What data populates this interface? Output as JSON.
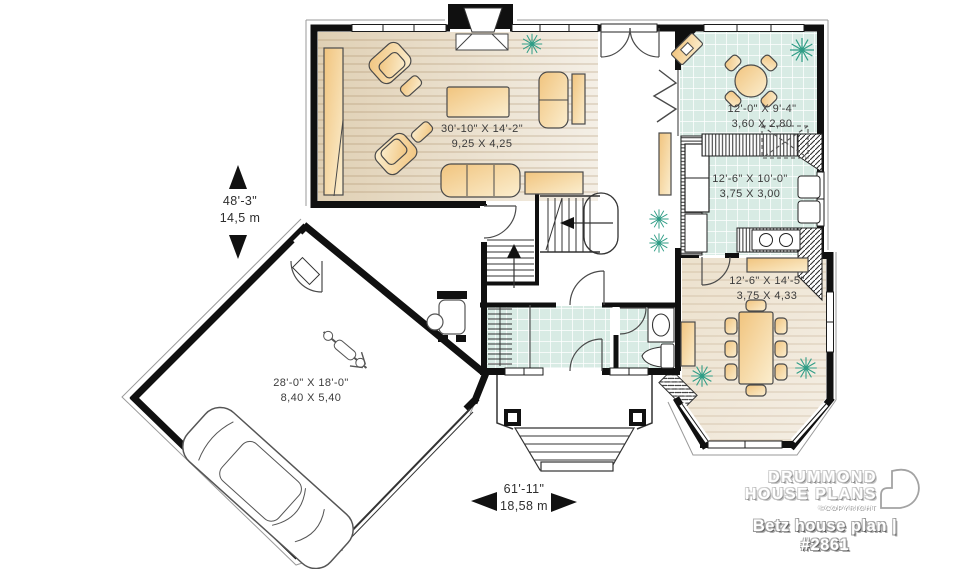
{
  "plan": {
    "rooms": [
      {
        "name": "living-room",
        "imperial": "30'-10\" X 14'-2\"",
        "metric": "9,25 X 4,25"
      },
      {
        "name": "breakfast-nook",
        "imperial": "12'-0\" X 9'-4\"",
        "metric": "3,60 X 2,80"
      },
      {
        "name": "kitchen",
        "imperial": "12'-6\" X 10'-0\"",
        "metric": "3,75 X 3,00"
      },
      {
        "name": "dining-room",
        "imperial": "12'-6\" X 14'-5\"",
        "metric": "3,75 X 4,33"
      },
      {
        "name": "garage",
        "imperial": "28'-0\" X 18'-0\"",
        "metric": "8,40 X 5,40"
      }
    ],
    "dimensions": {
      "height": {
        "imperial": "48'-3\"",
        "metric": "14,5 m"
      },
      "width": {
        "imperial": "61'-11\"",
        "metric": "18,58 m"
      }
    }
  },
  "branding": {
    "line1": "DRUMMOND",
    "line2": "HOUSE PLANS",
    "copyright": "©COPYRIGHT",
    "plan_title": "Betz house plan | #2861"
  },
  "colors": {
    "wall": "#111111",
    "tile": "#d8ebe4",
    "wood_floor": "#e7d9c2",
    "furniture": "#f2c985",
    "plant": "#2f9d86"
  }
}
